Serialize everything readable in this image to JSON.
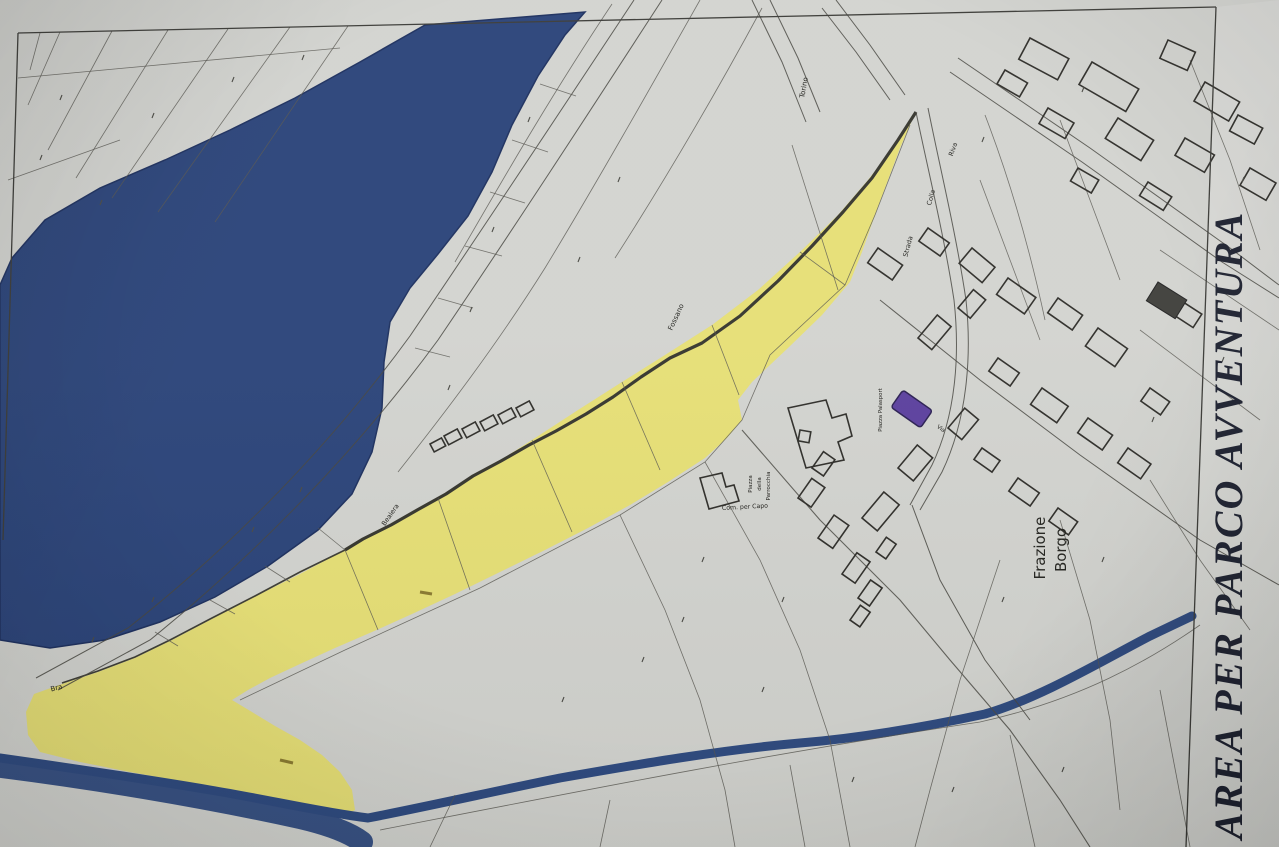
{
  "note": {
    "text": "AREA PER PARCO AVVENTURA"
  },
  "map_labels": {
    "frazione_line1": "Frazione",
    "frazione_line2": "Borgo",
    "piazza_parrocchia_1": "Piazza",
    "piazza_parrocchia_2": "della",
    "piazza_parrocchia_3": "Parrocchia",
    "piazza_palasport": "Piazza Palasport",
    "com_per_capo": "Com. per Capo",
    "torino": "Torino",
    "strada": "Strada",
    "colla": "Colla",
    "riva": "Riva",
    "fossano": "Fossano",
    "bealera": "Bealera",
    "bra": "Bra",
    "via": "Via"
  },
  "colors": {
    "paper": "#d2d3cf",
    "margin_paper": "#d8d9d5",
    "highlight_yellow": "#e7df6e",
    "river_blue": "#2a4379",
    "stream_blue": "#2e4a80",
    "building_purple": "#5b3f9e",
    "handwriting_ink": "#1d2130",
    "map_line": "#4a4a44"
  }
}
